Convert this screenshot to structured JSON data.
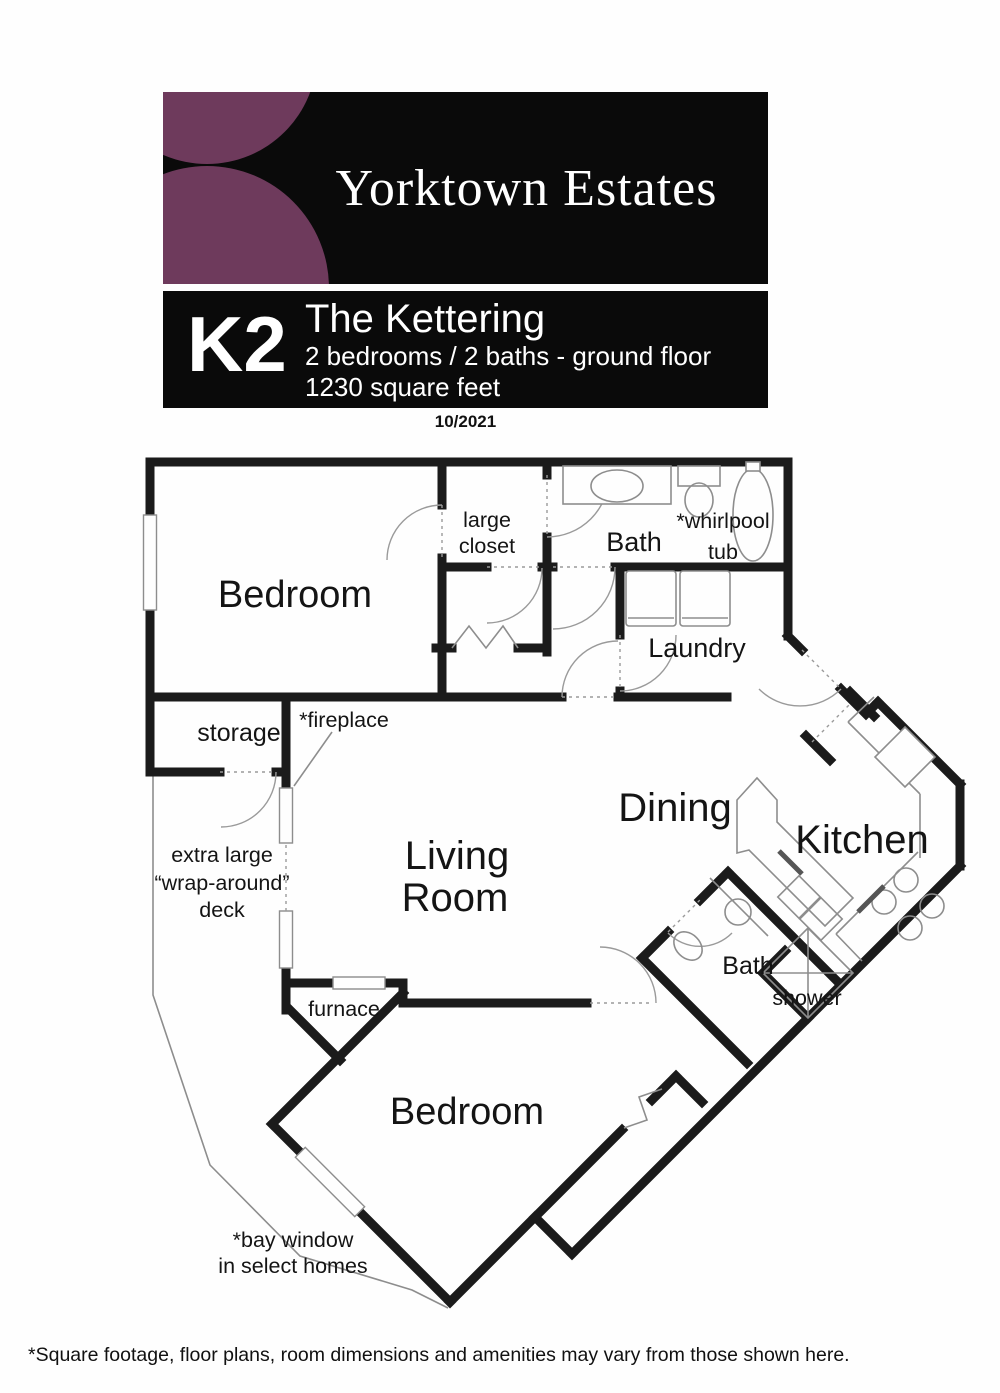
{
  "brand": {
    "name": "Yorktown Estates",
    "accent_color": "#6e3a5c",
    "panel_color": "#0a0a0a"
  },
  "plan_header": {
    "code": "K2",
    "name": "The Kettering",
    "specs": "2 bedrooms / 2 baths - ground floor",
    "area": "1230 square feet",
    "date": "10/2021"
  },
  "rooms": {
    "bedroom1": "Bedroom",
    "large_closet_line1": "large",
    "large_closet_line2": "closet",
    "bath1": "Bath",
    "whirlpool_line1": "*whirlpool",
    "whirlpool_line2": "tub",
    "laundry": "Laundry",
    "storage": "storage",
    "fireplace_note": "*fireplace",
    "deck_line1": "extra large",
    "deck_line2": "“wrap-around”",
    "deck_line3": "deck",
    "living_line1": "Living",
    "living_line2": "Room",
    "dining": "Dining",
    "kitchen": "Kitchen",
    "furnace": "furnace",
    "bath2": "Bath",
    "shower": "shower",
    "bedroom2": "Bedroom",
    "bay_note_line1": "*bay window",
    "bay_note_line2": "in select homes"
  },
  "footer": {
    "disclaimer": "*Square footage, floor plans, room dimensions  and amenities may vary from those shown here."
  }
}
